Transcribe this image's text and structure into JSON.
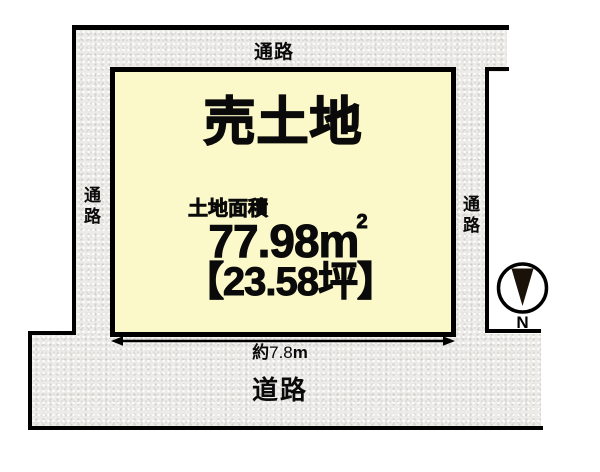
{
  "title": "売土地",
  "area": {
    "label": "土地面積",
    "m2_value": "77.98",
    "m2_unit": "m",
    "m2_sup": "2",
    "tsubo": "【23.58坪】"
  },
  "dimension": {
    "prefix": "約",
    "value": "7.8",
    "unit": "m"
  },
  "labels": {
    "passage_top": "通路",
    "passage_left": "通路",
    "passage_right": "通路",
    "road": "道路",
    "north": "N"
  },
  "colors": {
    "plot_fill": "#FBF9C9",
    "passage_fill": "#ECEBE8",
    "line_color": "#000000",
    "text_color": "#0A0A0A"
  }
}
